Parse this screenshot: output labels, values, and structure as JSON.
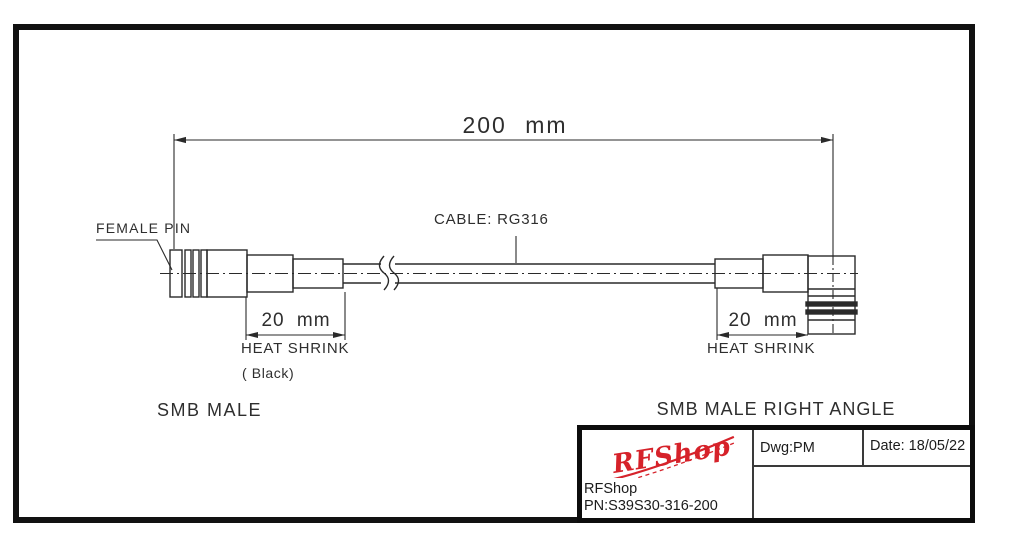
{
  "drawing": {
    "total_length_dim": "200 mm",
    "cable_label": "CABLE: RG316",
    "female_pin_label": "FEMALE PIN",
    "left_connector_label": "SMB MALE",
    "right_connector_label": "SMB MALE RIGHT ANGLE",
    "heat_shrink": {
      "left_dim": "20 mm",
      "right_dim": "20 mm",
      "left_label": "HEAT SHRINK",
      "right_label": "HEAT SHRINK",
      "color_note": "( Black)"
    }
  },
  "title_block": {
    "logo_text": "RFShop",
    "company": "RFShop",
    "part_number": "PN:S39S30-316-200",
    "dwg": "Dwg:PM",
    "date": "Date: 18/05/22"
  },
  "colors": {
    "line": "#2a2a2a",
    "logo_red": "#d6222a",
    "border": "#111111"
  }
}
